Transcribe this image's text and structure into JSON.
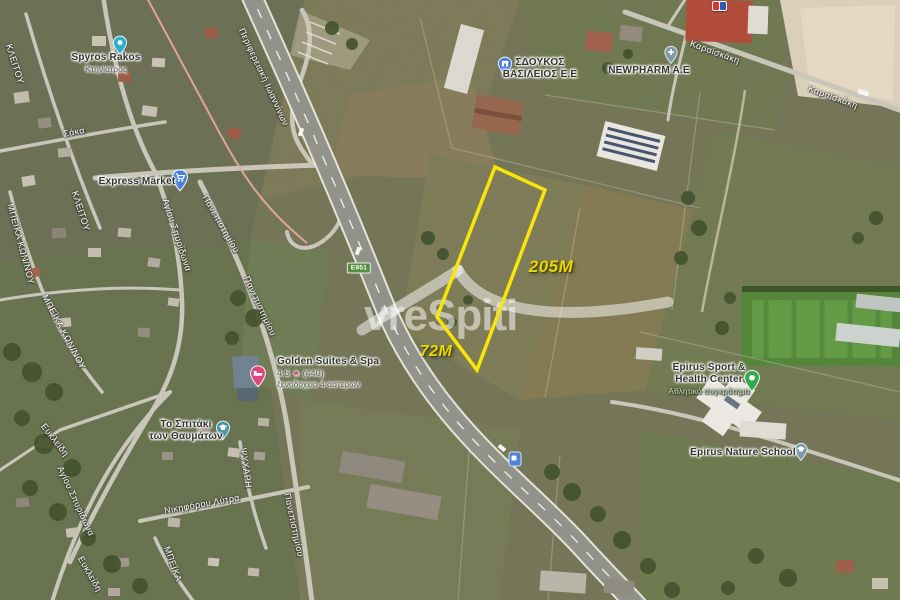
{
  "map": {
    "watermark_text": "vreSpiti",
    "plot": {
      "side_long_label": "205M",
      "side_short_label": "72M",
      "outline_color": "#F7E60A"
    },
    "badges": {
      "e_road": "E951"
    },
    "places": {
      "vet": {
        "name": "Spyros Rakos",
        "category": "Κτηνίατρος"
      },
      "market": {
        "name": "Express Market"
      },
      "sdoukos": {
        "name_line1": "ΣΔΟΥΚΟΣ",
        "name_line2": "ΒΑΣΙΛΕΙΟΣ Ε.Ε"
      },
      "newpharm": {
        "name": "NEWPHARM A.E"
      },
      "hotel": {
        "name": "Golden Suites & Spa",
        "rating": "4.6",
        "star": "★",
        "reviews": "(440)",
        "category": "ξενοδοχειο 4 αστερων"
      },
      "kindergarten": {
        "name_line1": "Το Σπιτάκι",
        "name_line2": "των Θαυμάτων"
      },
      "sport": {
        "name_line1": "Epirus Sport &",
        "name_line2": "Health Center",
        "category": "Αθλητικό συγκρότημα"
      },
      "nature_school": {
        "name": "Epirus Nature School"
      }
    },
    "streets": {
      "perifereiaki": "Περιφερειακή Ιωαννίνων",
      "karaiskaki": "Καραϊσκάκη",
      "panepistimiou": "Πανεπιστημίου",
      "agiou_spyridona": "Αγίου Σπυρίδωνα",
      "kleitou": "ΚΛΕΙΤΟΥ",
      "beika_kon": "ΜΠΕΪΚΑ ΚΩΝ/ΝΟΥ",
      "beika": "ΜΠΕΪΚΑ",
      "saka": "Σάκα",
      "eyklidi": "Ευκλείδη",
      "nikiforou_lytra": "Νικηφόρου Λύτρα",
      "psychari": "ΨΥΧΑΡΗ"
    },
    "colors": {
      "plot_outline": "#F7E60A",
      "measure_text": "#E6DA00",
      "hotel_pin": "#E0447E",
      "sport_pin": "#34A853",
      "blue_pin": "#4B7FE0",
      "teal_pin": "#27B0CF",
      "school_pin": "#8199A9",
      "e951_badge": "#568F3F",
      "highway_asphalt": "#91928A",
      "sand_pit": "#DBCFBA",
      "sports_field_green": "#53853A"
    }
  }
}
